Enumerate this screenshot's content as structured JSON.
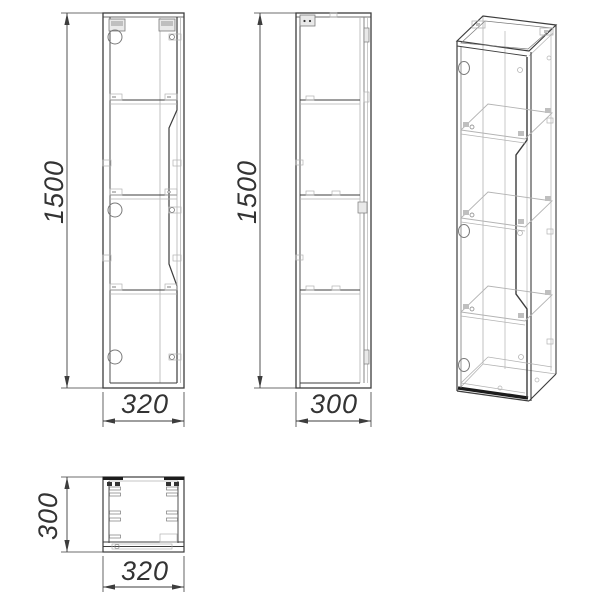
{
  "drawing": {
    "kind": "cabinet technical drawing, four views",
    "views": {
      "front": {
        "height_label": "1500",
        "width_label": "320"
      },
      "side": {
        "height_label": "1500",
        "depth_label": "300"
      },
      "top": {
        "depth_label": "300",
        "width_label": "320"
      }
    },
    "colors": {
      "line_dark": "#3d3d3d",
      "line_medium": "#7a7a7a",
      "line_light": "#b3b3b3",
      "accent_black": "#1c1c1c",
      "dim_text": "#333333",
      "background": "#ffffff"
    }
  }
}
